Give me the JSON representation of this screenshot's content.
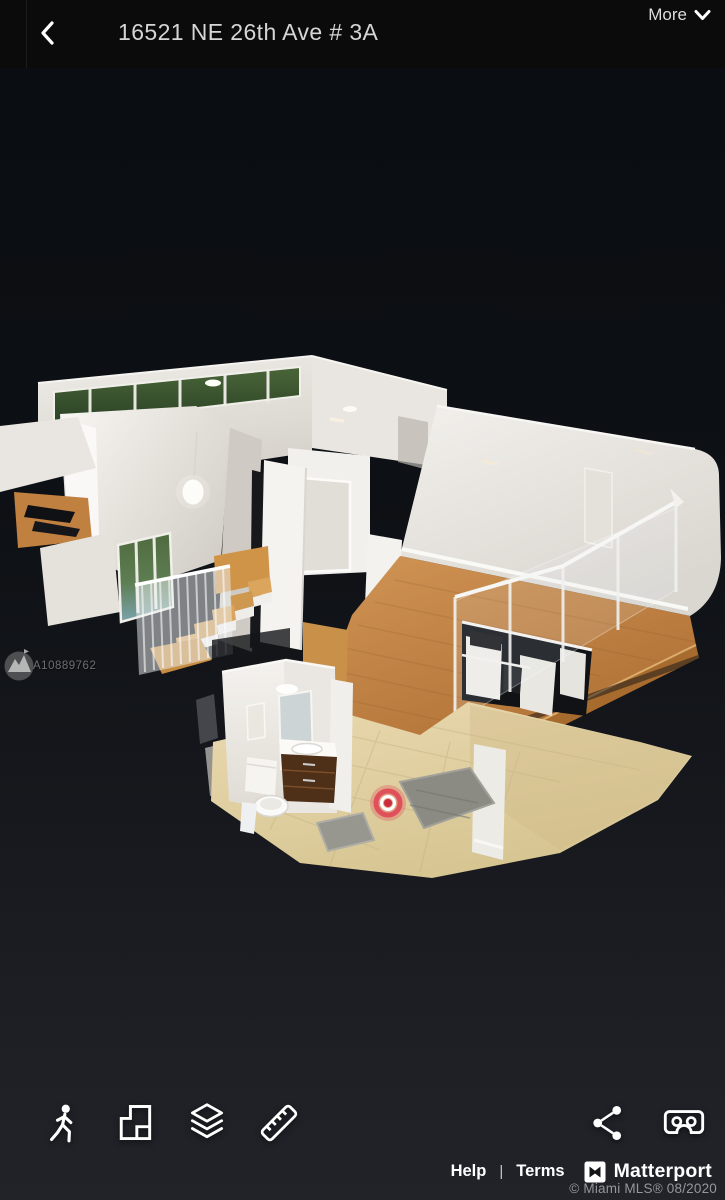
{
  "colors": {
    "topbar_bg": "#0b0b0b",
    "viewport_top": "#0a0d11",
    "viewport_bottom": "#212329",
    "title_text": "#d6d6d6",
    "icon_white": "#ffffff",
    "marker_red": "#e04254",
    "wood_floor": "#c48947",
    "wall_white": "#eceae5",
    "tile_floor": "#e2d3a8",
    "copyright_gray": "#94979b"
  },
  "header": {
    "title": "16521 NE 26th Ave # 3A",
    "more_label": "More",
    "back_icon": "chevron-left",
    "more_icon": "chevron-down"
  },
  "watermark": {
    "mls_id": "A10889762",
    "logo": "miami-mls-mountain-badge"
  },
  "scene": {
    "view_mode": "dollhouse-3d",
    "marker": "current-position-marker"
  },
  "toolbar": {
    "left": [
      {
        "name": "walkthrough-view",
        "icon": "person-walking"
      },
      {
        "name": "floorplan-view",
        "icon": "floorplan"
      },
      {
        "name": "floor-selector",
        "icon": "stacked-layers"
      },
      {
        "name": "measure-tool",
        "icon": "ruler"
      }
    ],
    "right": [
      {
        "name": "share",
        "icon": "share-nodes"
      },
      {
        "name": "vr-mode",
        "icon": "vr-goggles"
      }
    ]
  },
  "footer": {
    "help_label": "Help",
    "separator": "|",
    "terms_label": "Terms",
    "brand_name": "Matterport",
    "brand_icon": "matterport-m-logo",
    "copyright": "© Miami MLS® 08/2020"
  }
}
